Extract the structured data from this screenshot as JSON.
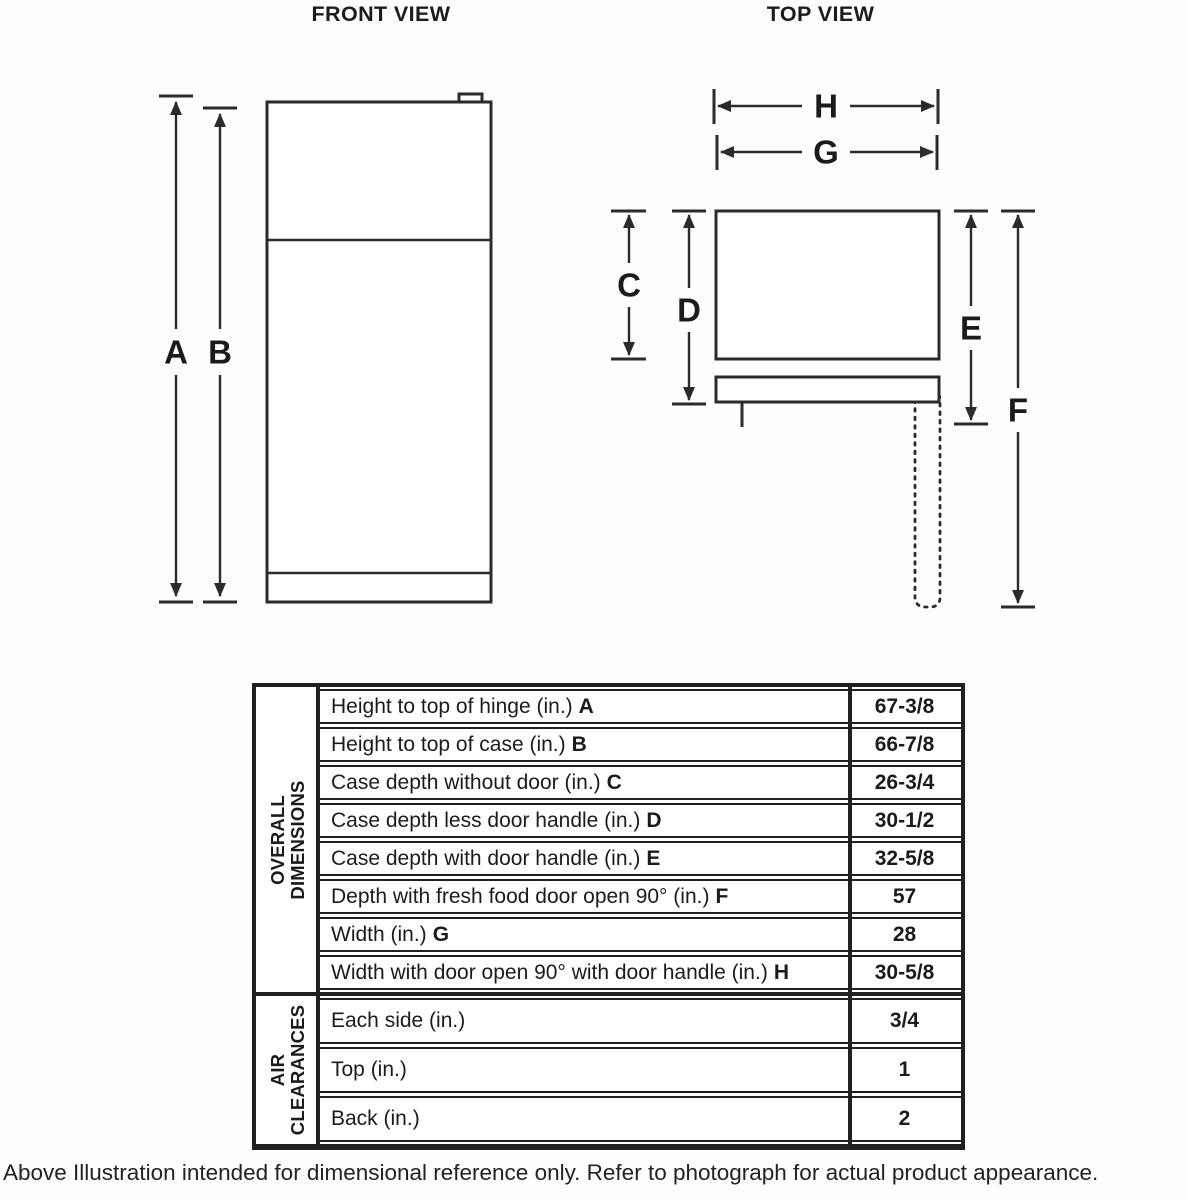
{
  "front_view": {
    "title": "FRONT VIEW",
    "labels": {
      "a": "A",
      "b": "B"
    }
  },
  "top_view": {
    "title": "TOP VIEW",
    "labels": {
      "c": "C",
      "d": "D",
      "e": "E",
      "f": "F",
      "g": "G",
      "h": "H"
    }
  },
  "table": {
    "sections": [
      {
        "header_lines": [
          "OVERALL",
          "DIMENSIONS"
        ],
        "rows": [
          {
            "label": "Height to top of hinge (in.)",
            "letter": "A",
            "value": "67-3/8"
          },
          {
            "label": "Height to top of case (in.)",
            "letter": "B",
            "value": "66-7/8"
          },
          {
            "label": "Case depth without door (in.)",
            "letter": "C",
            "value": "26-3/4"
          },
          {
            "label": "Case depth less door handle (in.)",
            "letter": "D",
            "value": "30-1/2"
          },
          {
            "label": "Case depth with door handle (in.)",
            "letter": "E",
            "value": "32-5/8"
          },
          {
            "label": "Depth with fresh food door open 90° (in.)",
            "letter": "F",
            "value": "57"
          },
          {
            "label": "Width (in.)",
            "letter": "G",
            "value": "28"
          },
          {
            "label": "Width with door open 90° with door handle (in.)",
            "letter": "H",
            "value": "30-5/8"
          }
        ]
      },
      {
        "header_lines": [
          "AIR",
          "CLEARANCES"
        ],
        "rows": [
          {
            "label": "Each side (in.)",
            "letter": "",
            "value": "3/4"
          },
          {
            "label": "Top (in.)",
            "letter": "",
            "value": "1"
          },
          {
            "label": "Back (in.)",
            "letter": "",
            "value": "2"
          }
        ]
      }
    ]
  },
  "footer": {
    "note": "Above Illustration intended for dimensional reference only. Refer to photograph for actual product appearance."
  },
  "colors": {
    "ink": "#2b2b2b",
    "background": "#fdfdfd"
  }
}
